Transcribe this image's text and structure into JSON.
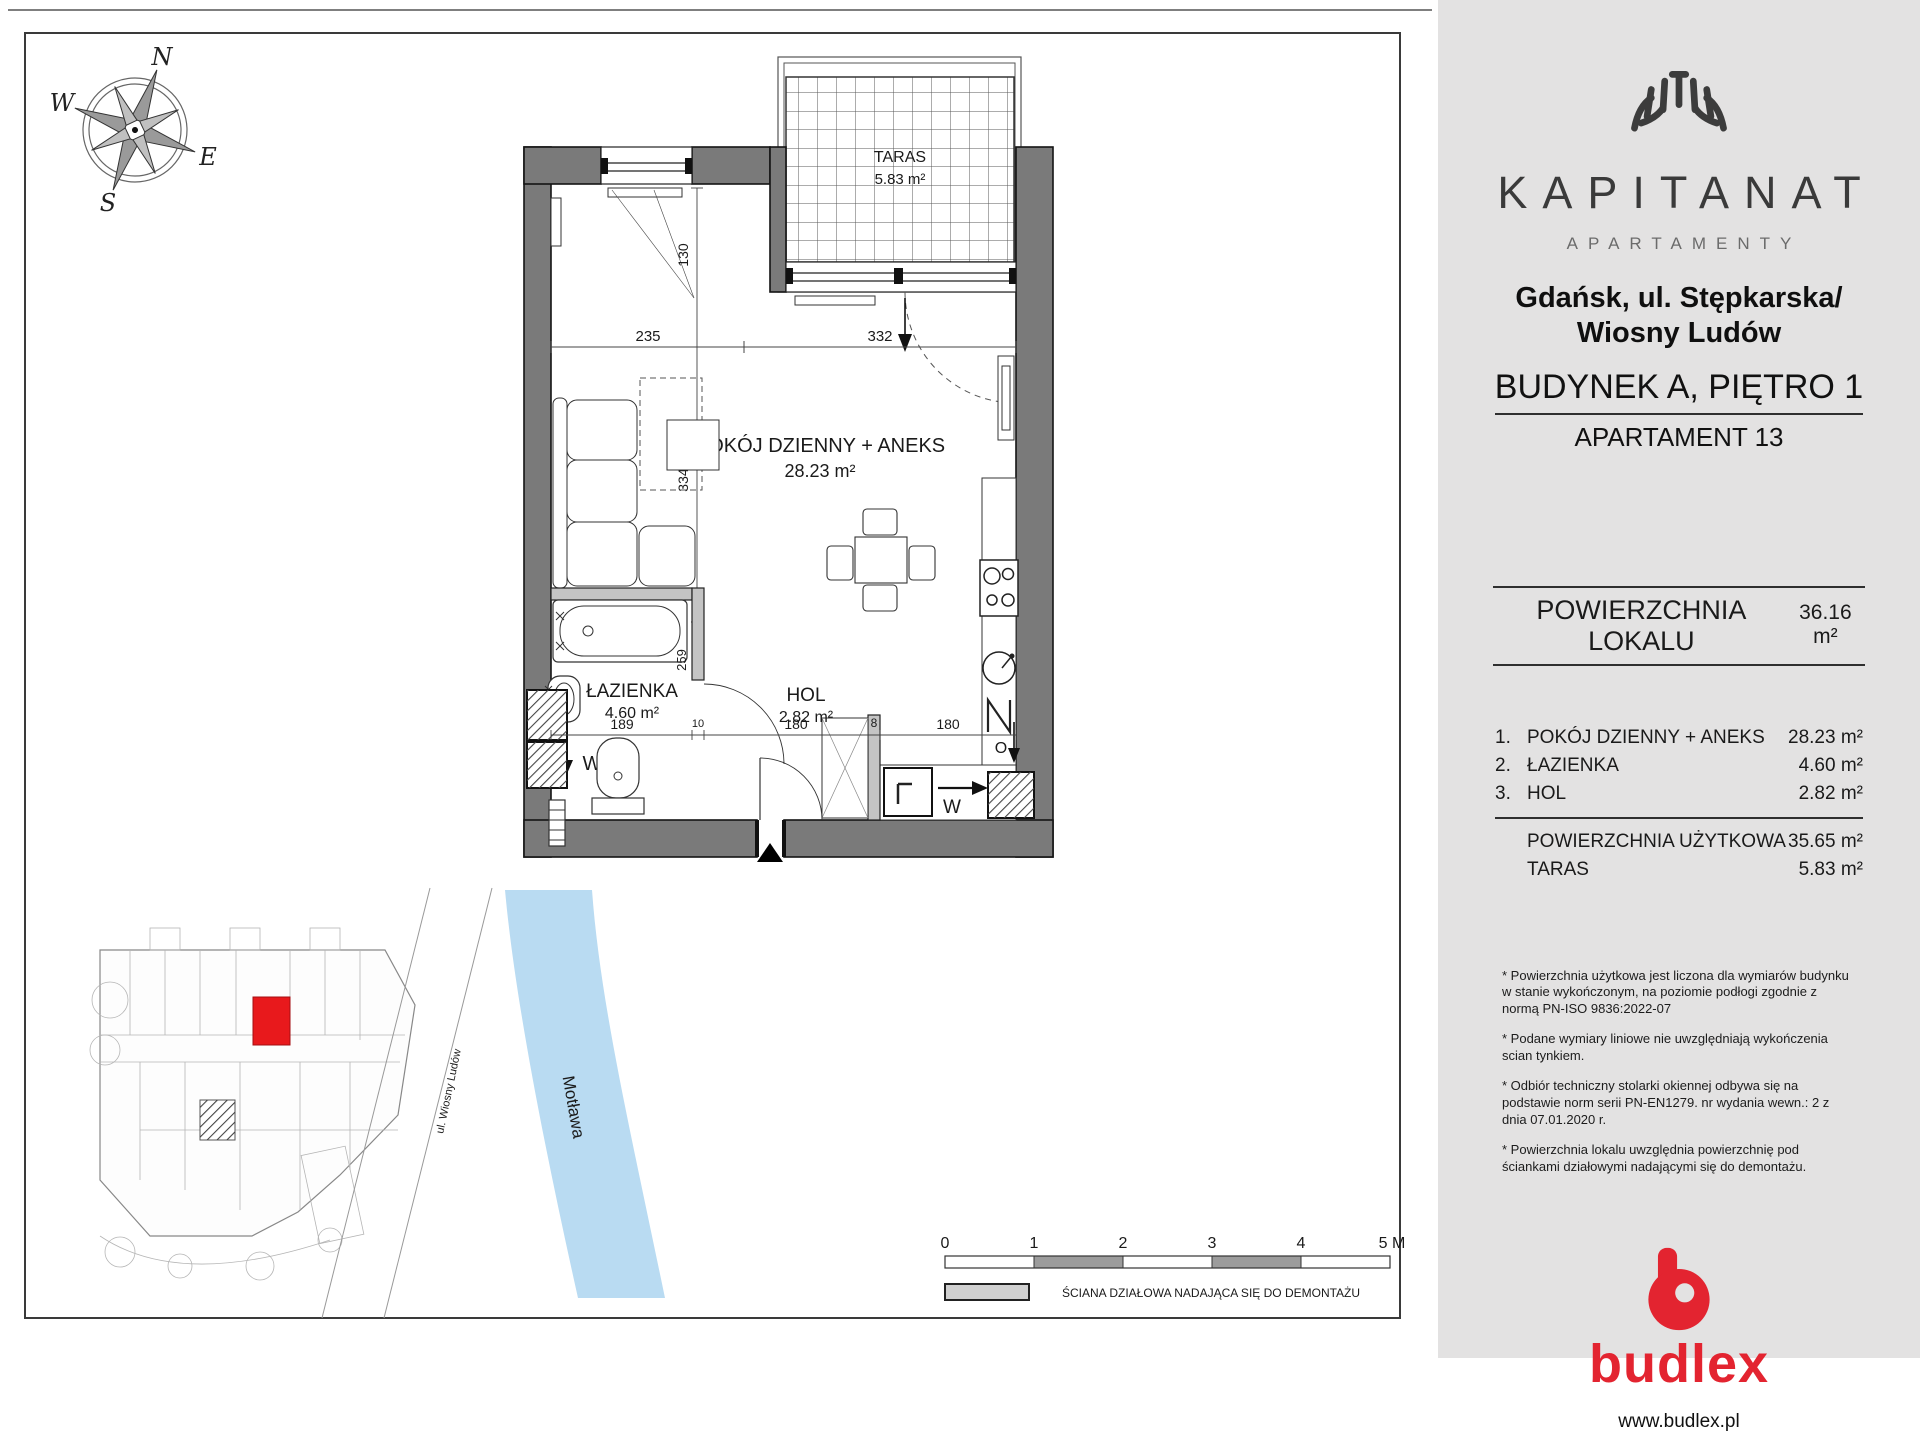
{
  "plan": {
    "compass": {
      "n": "N",
      "e": "E",
      "s": "S",
      "w": "W"
    },
    "terrace": {
      "name": "TARAS",
      "area": "5.83 m²"
    },
    "living": {
      "name": "POKÓJ DZIENNY + ANEKS",
      "area": "28.23 m²"
    },
    "bathroom": {
      "name": "ŁAZIENKA",
      "area": "4.60 m²"
    },
    "hall": {
      "name": "HOL",
      "area": "2.82 m²"
    },
    "dims": {
      "niche": "130",
      "w_left": "235",
      "w_right": "332",
      "h_living": "334",
      "bath_w": "189",
      "wall10": "10",
      "hall_w": "180",
      "part8": "8",
      "kitchen_w": "180",
      "bath_h": "259"
    },
    "markers": {
      "w_bath": "W",
      "w_kitchen": "W",
      "o": "O"
    },
    "site_plan": {
      "river": "Motława",
      "street": "ul. Wiosny Ludów"
    },
    "scale_bar": {
      "ticks": [
        "0",
        "1",
        "2",
        "3",
        "4",
        "5 M"
      ]
    },
    "legend": {
      "partition_wall": "ŚCIANA DZIAŁOWA NADAJĄCA SIĘ DO DEMONTAŻU"
    }
  },
  "sidebar": {
    "brand": {
      "name": "KAPITANAT",
      "tagline": "APARTAMENTY"
    },
    "address": "Gdańsk, ul. Stępkarska/ Wiosny Ludów",
    "building": "BUDYNEK A, PIĘTRO 1",
    "apartment": "APARTAMENT 13",
    "area_total": {
      "label": "POWIERZCHNIA LOKALU",
      "value": "36.16 m²"
    },
    "rooms": [
      {
        "no": "1.",
        "name": "POKÓJ DZIENNY + ANEKS",
        "area": "28.23 m²"
      },
      {
        "no": "2.",
        "name": "ŁAZIENKA",
        "area": "4.60 m²"
      },
      {
        "no": "3.",
        "name": "HOL",
        "area": "2.82 m²"
      }
    ],
    "totals": [
      {
        "name": "POWIERZCHNIA UŻYTKOWA",
        "area": "35.65 m²"
      },
      {
        "name": "TARAS",
        "area": "5.83 m²"
      }
    ],
    "footnotes": [
      "* Powierzchnia użytkowa jest liczona dla wymiarów budynku w stanie wykończonym, na poziomie podłogi zgodnie z normą PN-ISO 9836:2022-07",
      "* Podane wymiary liniowe nie uwzględniają wykończenia scian tynkiem.",
      "* Odbiór techniczny stolarki okiennej odbywa się na podstawie norm serii PN-EN1279. nr wydania wewn.: 2 z dnia 07.01.2020 r.",
      "* Powierzchnia lokalu uwzględnia powierzchnię pod ściankami działowymi nadającymi się do demontażu."
    ],
    "footer": {
      "logo": "budlex",
      "url": "www.budlex.pl"
    },
    "colors": {
      "accent_red": "#e32430",
      "panel_bg": "#e3e2e2",
      "wall_grey": "#7a7a7a",
      "river_blue": "#b9dbf2",
      "highlight_red": "#e8191c"
    }
  }
}
